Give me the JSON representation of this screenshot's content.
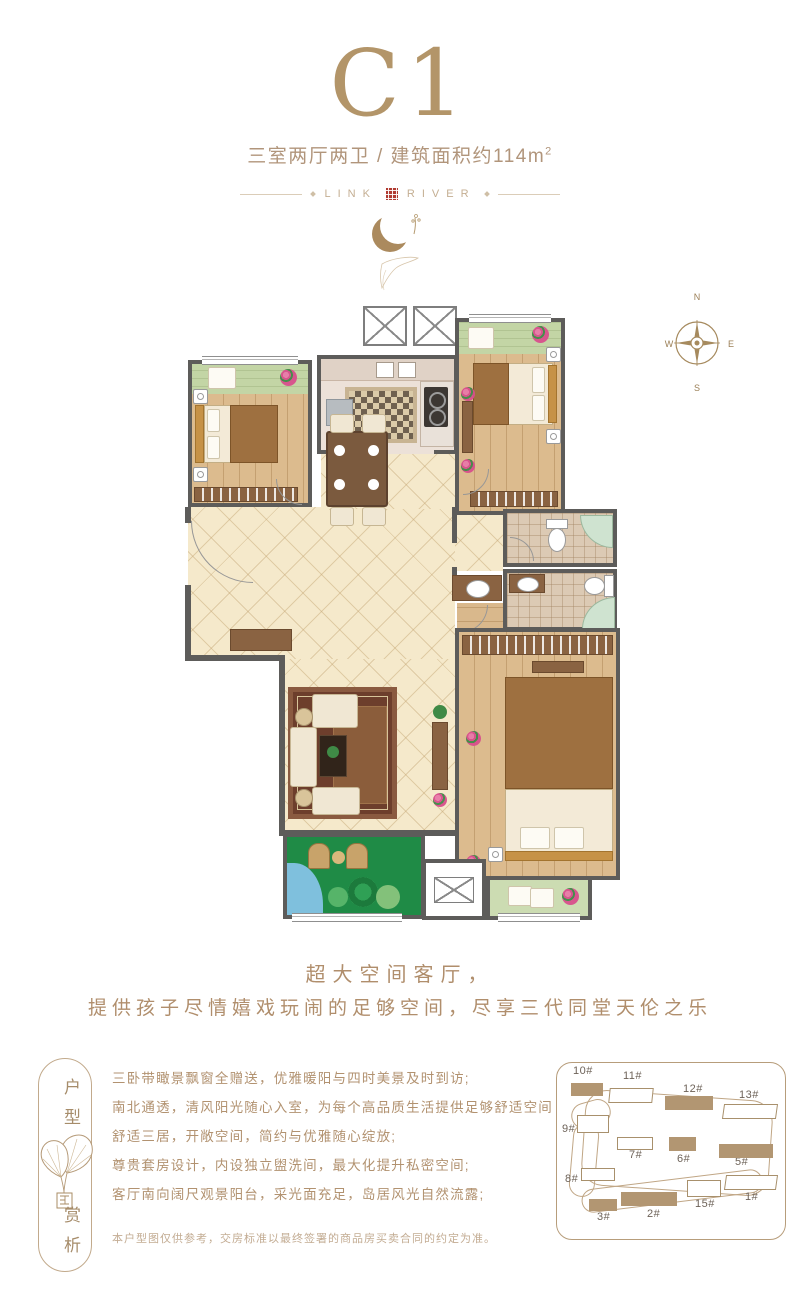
{
  "header": {
    "title": "C1",
    "subtitle": "三室两厅两卫 / 建筑面积约114m",
    "subtitle_sup": "2",
    "brand_left": "LINK",
    "brand_right": "RIVER"
  },
  "compass": {
    "north": "N",
    "east": "E",
    "south": "S",
    "west": "W"
  },
  "slogan": {
    "line1": "超大空间客厅，",
    "line2": "提供孩子尽情嬉戏玩闹的足够空间，尽享三代同堂天伦之乐"
  },
  "sidebar": {
    "top": "户型",
    "bottom": "赏析"
  },
  "features": [
    "三卧带瞰景飘窗全赠送，优雅暖阳与四时美景及时到访;",
    "南北通透，清风阳光随心入室，为每个高品质生活提供足够舒适空间",
    "舒适三居，开敞空间，简约与优雅随心绽放;",
    "尊贵套房设计，内设独立盥洗间，最大化提升私密空间;",
    "客厅南向阔尺观景阳台，采光面充足，岛居风光自然流露;"
  ],
  "disclaimer": "本户型图仅供参考，交房标准以最终签署的商品房买卖合同的约定为准。",
  "site_map": {
    "buildings": [
      {
        "label": "10#",
        "filled": true
      },
      {
        "label": "11#",
        "filled": false
      },
      {
        "label": "12#",
        "filled": true
      },
      {
        "label": "13#",
        "filled": false
      },
      {
        "label": "9#",
        "filled": false
      },
      {
        "label": "7#",
        "filled": false
      },
      {
        "label": "6#",
        "filled": true
      },
      {
        "label": "5#",
        "filled": true
      },
      {
        "label": "8#",
        "filled": false
      },
      {
        "label": "3#",
        "filled": true
      },
      {
        "label": "2#",
        "filled": true
      },
      {
        "label": "15#",
        "filled": false
      },
      {
        "label": "1#",
        "filled": false
      }
    ]
  },
  "colors": {
    "accent_gold": "#b2966e",
    "seal_red": "#b03a31",
    "wall_gray": "#5d5c5a",
    "balcony_green": "#c3d5a5",
    "garden_green": "#1f8b46",
    "floor_wood": "#dcbb8e",
    "tile_cream": "#f5e9cb"
  }
}
